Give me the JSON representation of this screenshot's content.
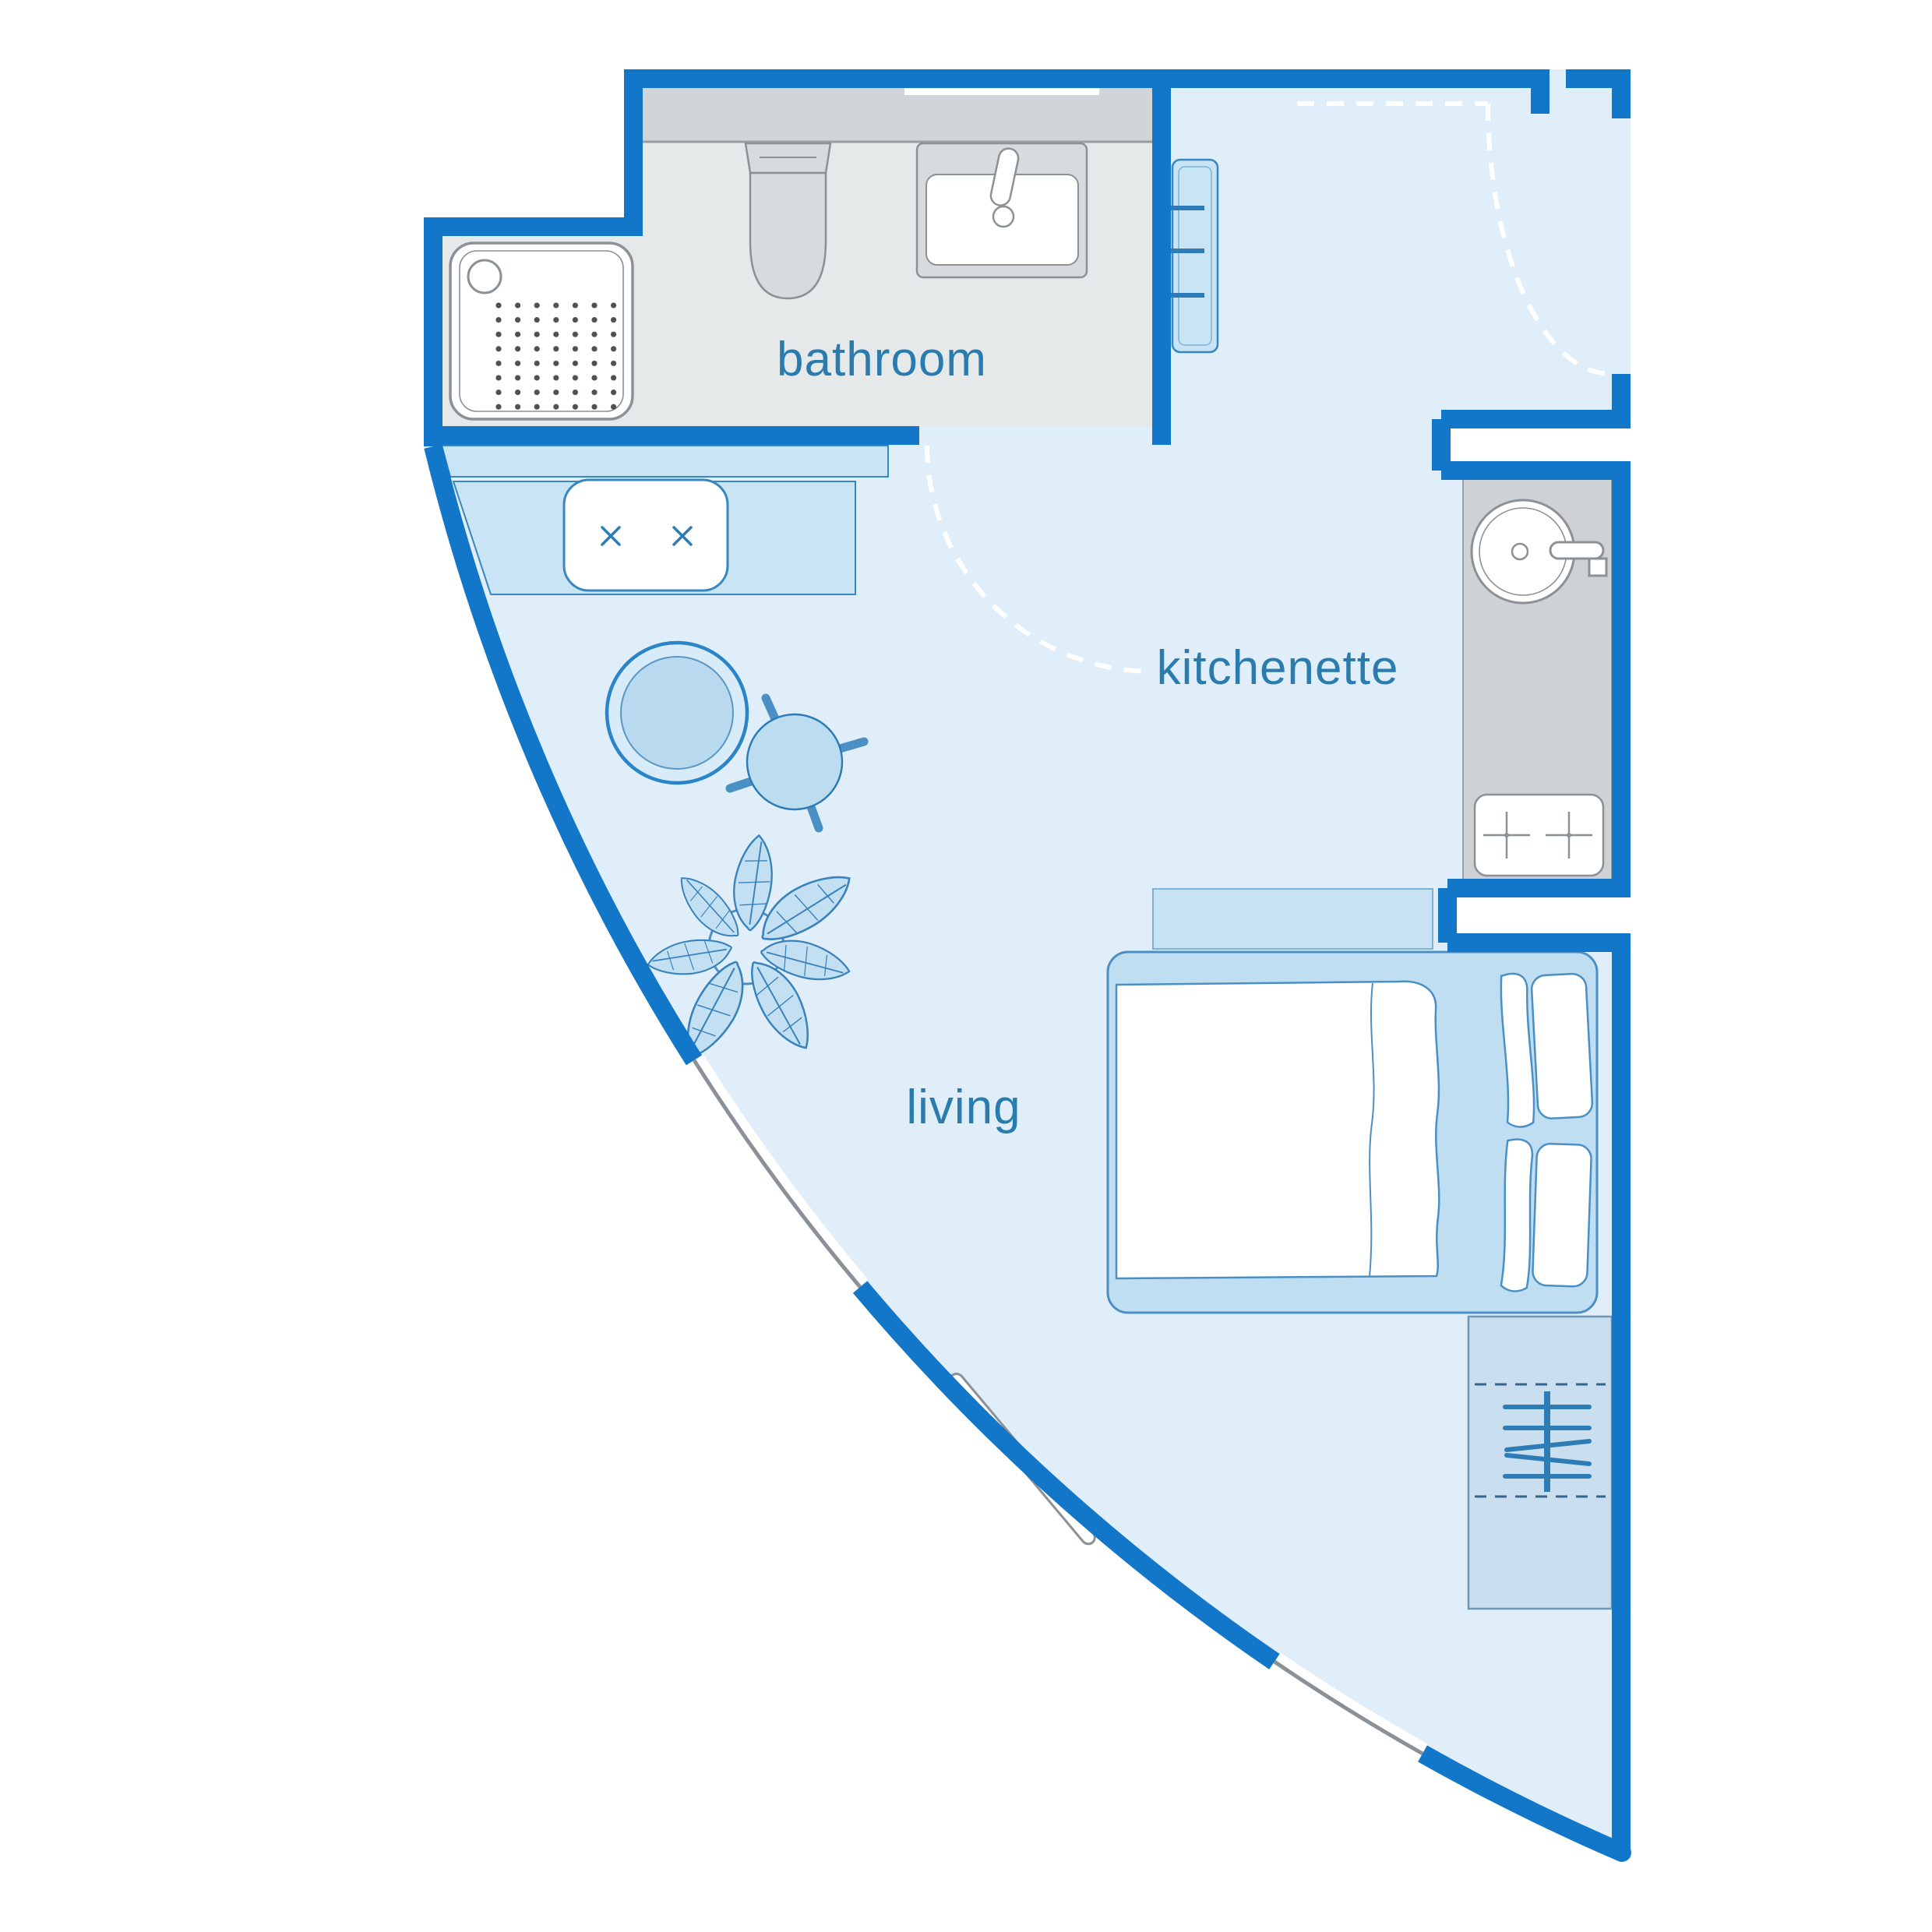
{
  "title": "studio apartment floor plan",
  "rooms": {
    "bathroom": {
      "label": "bathroom"
    },
    "kitchenette": {
      "label": "kitchenette"
    },
    "living": {
      "label": "living"
    }
  },
  "doors": [
    "entry-door-swing",
    "bathroom-door-swing"
  ],
  "windows": {
    "curved_wall_segments": 2,
    "bathroom_mirror_strip": 1
  },
  "furniture": [
    "shower-tray",
    "toilet",
    "bathroom-sink",
    "vanity-counter",
    "mirror",
    "entry-radiator",
    "wall-shelf",
    "desk",
    "sofa",
    "rug",
    "side-table",
    "plant",
    "kitchen-counter",
    "kitchen-sink",
    "kitchen-faucet",
    "hob",
    "headboard-shelf",
    "double-bed",
    "duvet",
    "pillow",
    "wardrobe",
    "hanger-rail",
    "radiator-bench"
  ],
  "colors": {
    "wall_blue": "#1277c9",
    "room_floor": "#dfeef9",
    "bathroom_floor": "#e6e9ea",
    "counter_gray": "#d2d5d7",
    "kitchen_counter_gray": "#ced2d4",
    "furniture_fill": "#c8e4f5",
    "furniture_fill_deep": "#b9d9ee",
    "furniture_stroke": "#3a86bf",
    "fixture_fill": "#d9dcde",
    "fixture_stroke": "#8b9196",
    "label_text": "#2a7cae",
    "door_swing": "#ffffff"
  }
}
